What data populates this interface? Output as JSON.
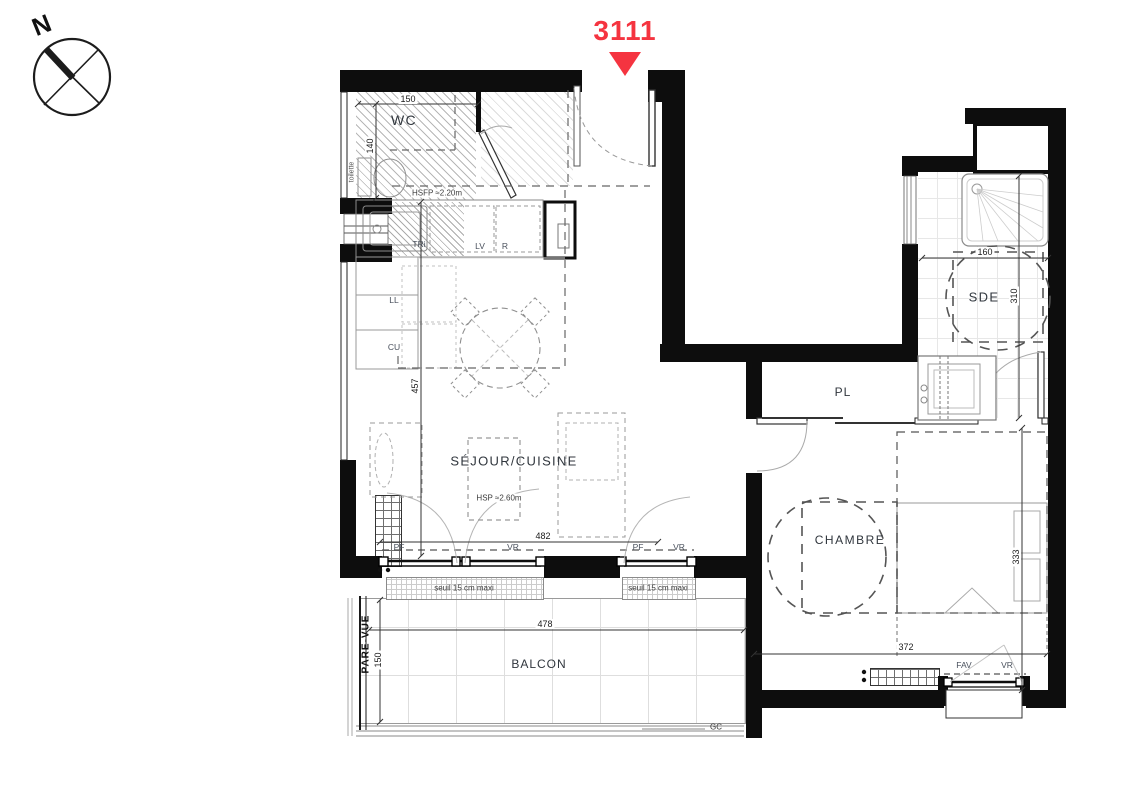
{
  "unit": {
    "number": "3111",
    "marker_color": "#f53440"
  },
  "compass": {
    "north": "N"
  },
  "colors": {
    "wall": "#0d0d0d",
    "line": "#8a8a8a",
    "marker_red": "#f53440"
  },
  "rooms": {
    "wc": {
      "label": "WC",
      "dim_width": "150",
      "dim_depth": "140",
      "fixture": "toilette",
      "ceiling_note": "HSFP ≈2.20m"
    },
    "sejour_cuisine": {
      "label": "SÉJOUR/CUISINE",
      "ceiling_note": "HSP ≈2.60m",
      "dim_depth": "457",
      "dim_width": "482"
    },
    "chambre": {
      "label": "CHAMBRE",
      "dim_depth": "333",
      "dim_width": "372"
    },
    "sde": {
      "label": "SDE",
      "dim_width": "160",
      "dim_depth": "310"
    },
    "placard": {
      "label": "PL"
    },
    "balcon": {
      "label": "BALCON",
      "dim_width": "478",
      "dim_depth": "150",
      "screen_label": "PARE-VUE",
      "drain_label": "GC"
    }
  },
  "kitchen_labels": {
    "sink": "TRi",
    "dishwasher": "LV",
    "fridge": "R",
    "washer": "LL",
    "kitchen_unit": "CU"
  },
  "openings": {
    "sejour_window_1": {
      "left": "PF",
      "right": "VR",
      "sill_note": "seuil 15 cm maxi"
    },
    "sejour_window_2": {
      "left": "PF",
      "right": "VR",
      "sill_note": "seuil 15 cm maxi"
    },
    "chambre_window": {
      "left": "FAV",
      "right": "VR"
    }
  }
}
